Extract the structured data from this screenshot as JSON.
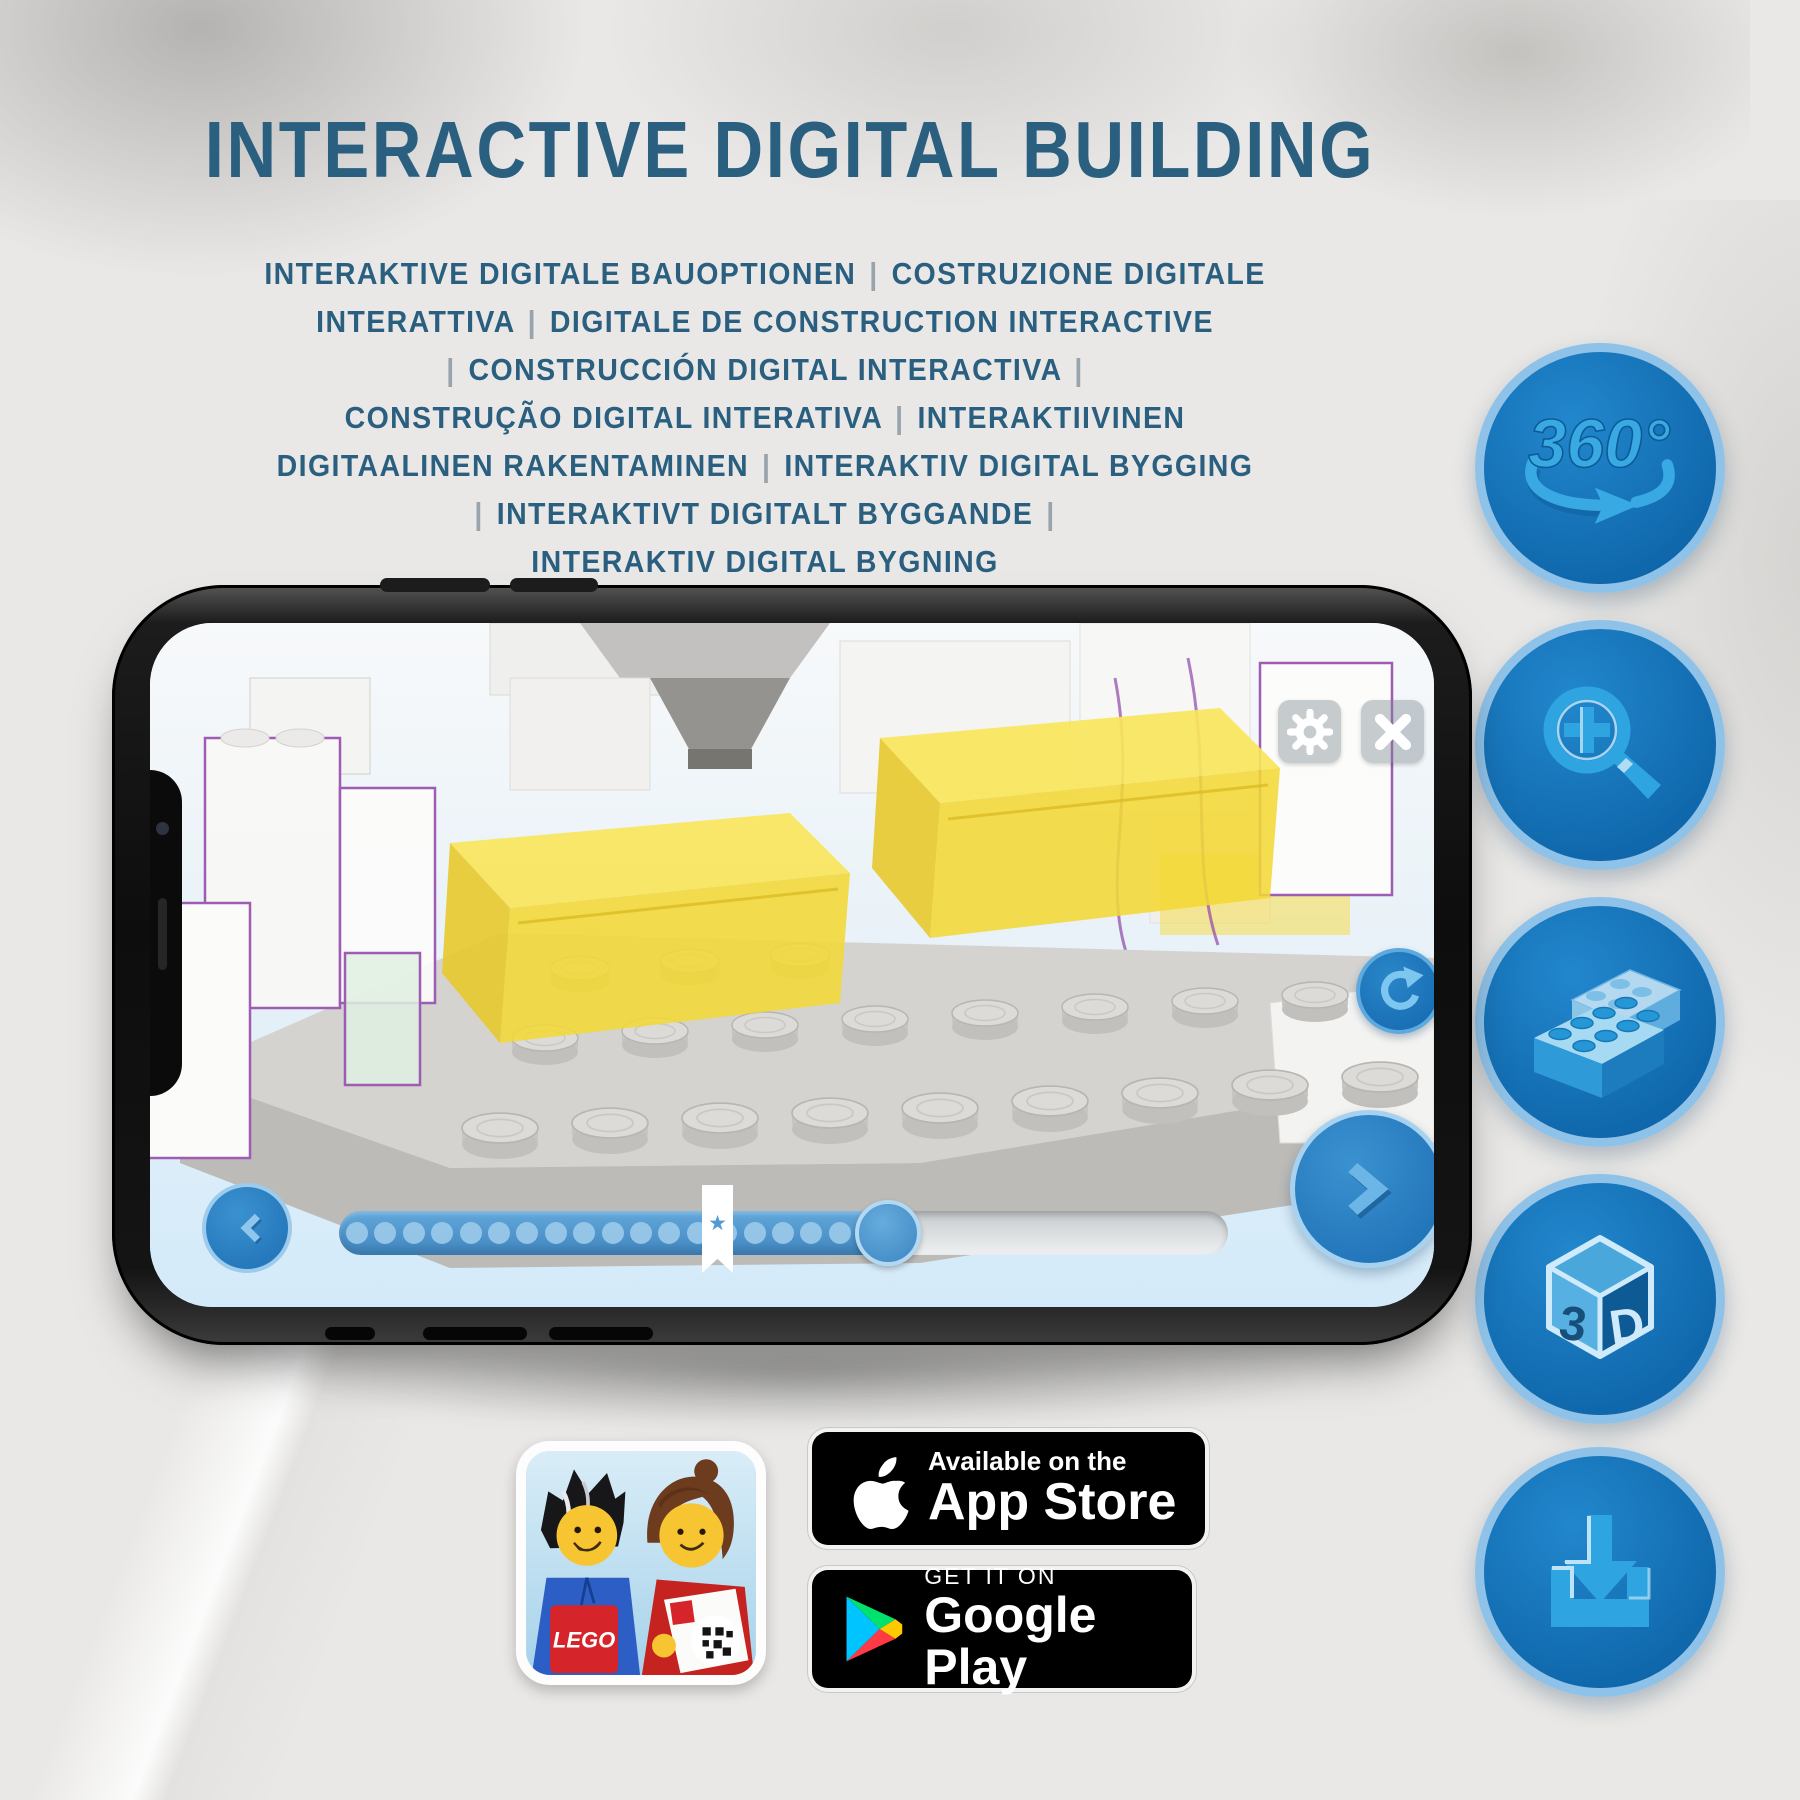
{
  "title": "INTERACTIVE DIGITAL BUILDING",
  "subtitle_lines": [
    "INTERAKTIVE DIGITALE BAUOPTIONEN | COSTRUZIONE DIGITALE",
    "INTERATTIVA | DIGITALE DE CONSTRUCTION INTERACTIVE",
    "| CONSTRUCCIÓN DIGITAL INTERACTIVA |",
    "CONSTRUÇÃO DIGITAL INTERATIVA | INTERAKTIIVINEN",
    "DIGITAALINEN RAKENTAMINEN | INTERAKTIV DIGITAL BYGGING",
    "| INTERAKTIVT DIGITALT BYGGANDE |",
    "INTERAKTIV DIGITAL BYGNING"
  ],
  "feature_icons": [
    {
      "id": "360-rotation",
      "label": "360°"
    },
    {
      "id": "zoom-in",
      "label": ""
    },
    {
      "id": "stacked-bricks",
      "label": ""
    },
    {
      "id": "3d-cube",
      "front_letter": "3",
      "side_letter": "D"
    },
    {
      "id": "download",
      "label": ""
    }
  ],
  "phone_ui": {
    "icons": [
      "settings-gear",
      "close-x",
      "rotate-cw",
      "previous-step",
      "next-step"
    ],
    "progress": {
      "dot_count": 19,
      "dot_start_x": 18,
      "dot_step": 28.4,
      "fill_percent": 63.7,
      "star_glyph": "★"
    }
  },
  "badges": {
    "lego_logo_text": "LEGO",
    "app_store": {
      "tagline": "Available on the",
      "name": "App Store"
    },
    "google_play": {
      "tagline": "GET IT ON",
      "name": "Google Play"
    }
  },
  "colors": {
    "heading_blue": "#2a5f80",
    "icon_circle_fill": "#1173b9",
    "icon_circle_ring": "#8fc2e8",
    "icon_glyph_blue": "#31a5e0",
    "lego_yellow": "#f3d836",
    "outline_purple": "#9e5cb3"
  }
}
